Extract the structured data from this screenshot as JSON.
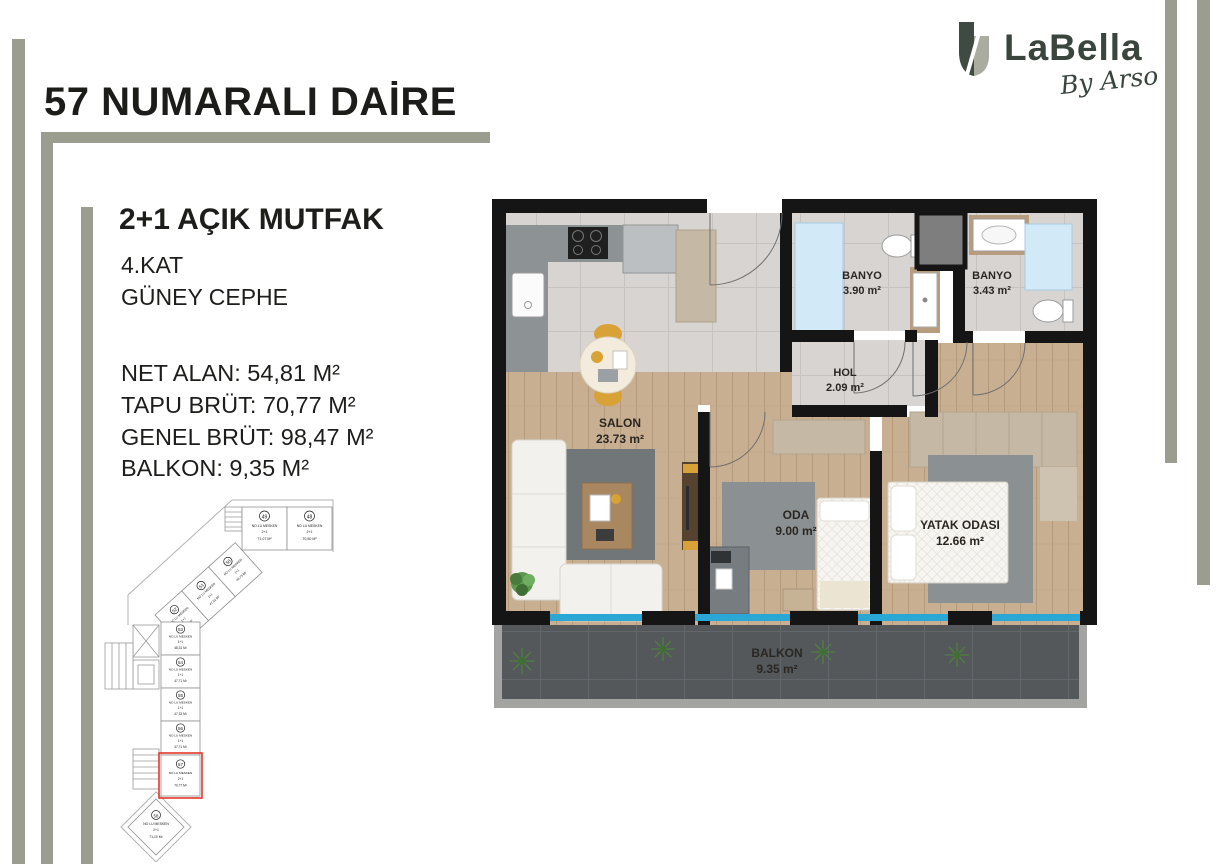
{
  "page": {
    "title": "57 NUMARALI DAİRE"
  },
  "logo": {
    "name": "LaBella",
    "tagline": "By Arso"
  },
  "info": {
    "unit_type": "2+1 AÇIK MUTFAK",
    "floor": "4.KAT",
    "facade": "GÜNEY CEPHE",
    "area_lines": [
      "NET ALAN: 54,81 M²",
      "TAPU BRÜT: 70,77 M²",
      "GENEL BRÜT: 98,47 M²",
      "BALKON: 9,35 M²"
    ]
  },
  "keyplan": {
    "highlighted_unit": "57",
    "highlight_color": "#e53629",
    "units": [
      {
        "no": "49",
        "label": "NO LU MESKEN",
        "type": "2+1",
        "area": "71,07 M²"
      },
      {
        "no": "48",
        "label": "NO LU MESKEN",
        "type": "2+1",
        "area": "70,50 M²"
      },
      {
        "no": "50",
        "label": "NO LU MESKEN",
        "type": "1+1",
        "area": "48,75 M²"
      },
      {
        "no": "51",
        "label": "NO LU MESKEN",
        "type": "1+1",
        "area": "47,52 M²"
      },
      {
        "no": "52",
        "label": "NO LU MESKEN",
        "type": "1+1",
        "area": "48,27 M²"
      },
      {
        "no": "53",
        "label": "NO LU MESKEN",
        "type": "1+1",
        "area": "48,31 M²"
      },
      {
        "no": "54",
        "label": "NO LU MESKEN",
        "type": "1+1",
        "area": "47,71 M²"
      },
      {
        "no": "55",
        "label": "NO LU MESKEN",
        "type": "1+1",
        "area": "47,33 M²"
      },
      {
        "no": "56",
        "label": "NO LU MESKEN",
        "type": "1+1",
        "area": "47,71 M²"
      },
      {
        "no": "57",
        "label": "NO LU MESKEN",
        "type": "2+1",
        "area": "70,77 M²"
      },
      {
        "no": "58",
        "label": "NO LU MESKEN",
        "type": "2+1",
        "area": "71,10 M²"
      }
    ]
  },
  "floorplan": {
    "rooms": {
      "salon": {
        "name": "SALON",
        "area": "23.73 m²"
      },
      "banyo1": {
        "name": "BANYO",
        "area": "3.90 m²"
      },
      "banyo2": {
        "name": "BANYO",
        "area": "3.43 m²"
      },
      "hol": {
        "name": "HOL",
        "area": "2.09 m²"
      },
      "oda": {
        "name": "ODA",
        "area": "9.00 m²"
      },
      "yatak": {
        "name": "YATAK ODASI",
        "area": "12.66 m²"
      },
      "balkon": {
        "name": "BALKON",
        "area": "9.35 m²"
      }
    }
  },
  "colors": {
    "accent_sage": "#9b9e8e",
    "logo_dark": "#3e4a42",
    "logo_light": "#a9ac9e",
    "wall_black": "#151515",
    "glass_blue": "#2ba7d6",
    "highlight_red": "#e53629",
    "wood_floor": "#c9af92",
    "tile_floor": "#d7d4d1",
    "balcony_floor": "#54585b"
  }
}
